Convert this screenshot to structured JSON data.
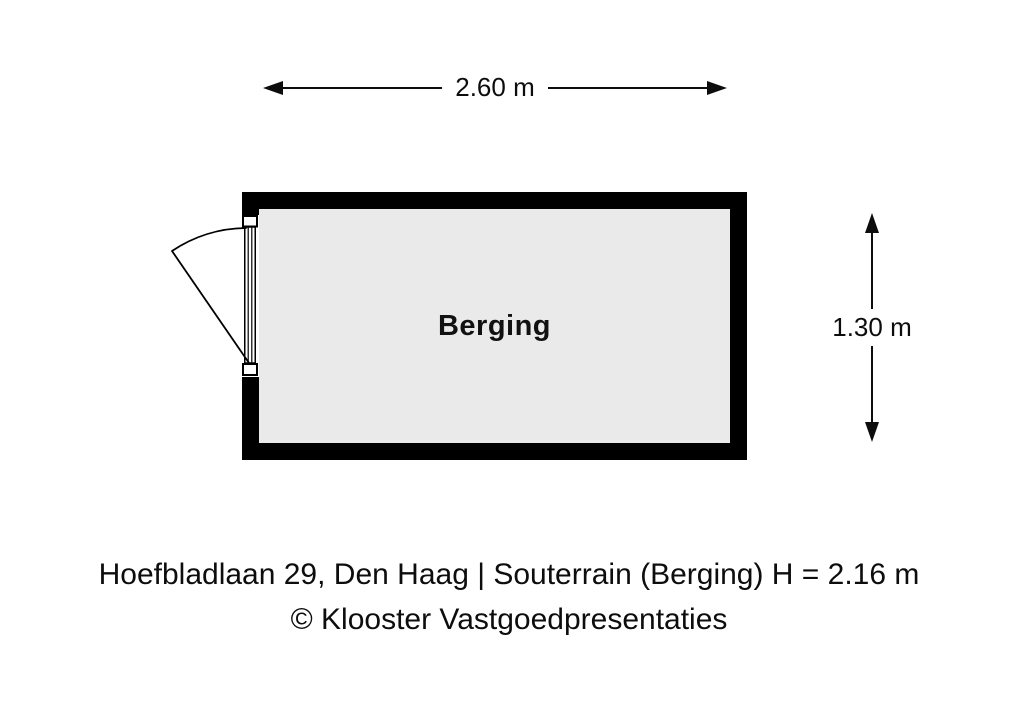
{
  "floorplan": {
    "room_label": "Berging",
    "width_dimension": "2.60 m",
    "height_dimension": "1.30 m"
  },
  "caption": {
    "line1": "Hoefbladlaan 29, Den Haag | Souterrain (Berging) H = 2.16 m",
    "line2": "© Klooster Vastgoedpresentaties"
  },
  "icons": {
    "width_arrows": "double-headed-horizontal-arrow",
    "height_arrows": "double-headed-vertical-arrow",
    "door": "door-swing-arc"
  },
  "colors": {
    "wall": "#000000",
    "room_fill": "#eaeaea",
    "background": "#ffffff",
    "text": "#0d0d0d"
  }
}
